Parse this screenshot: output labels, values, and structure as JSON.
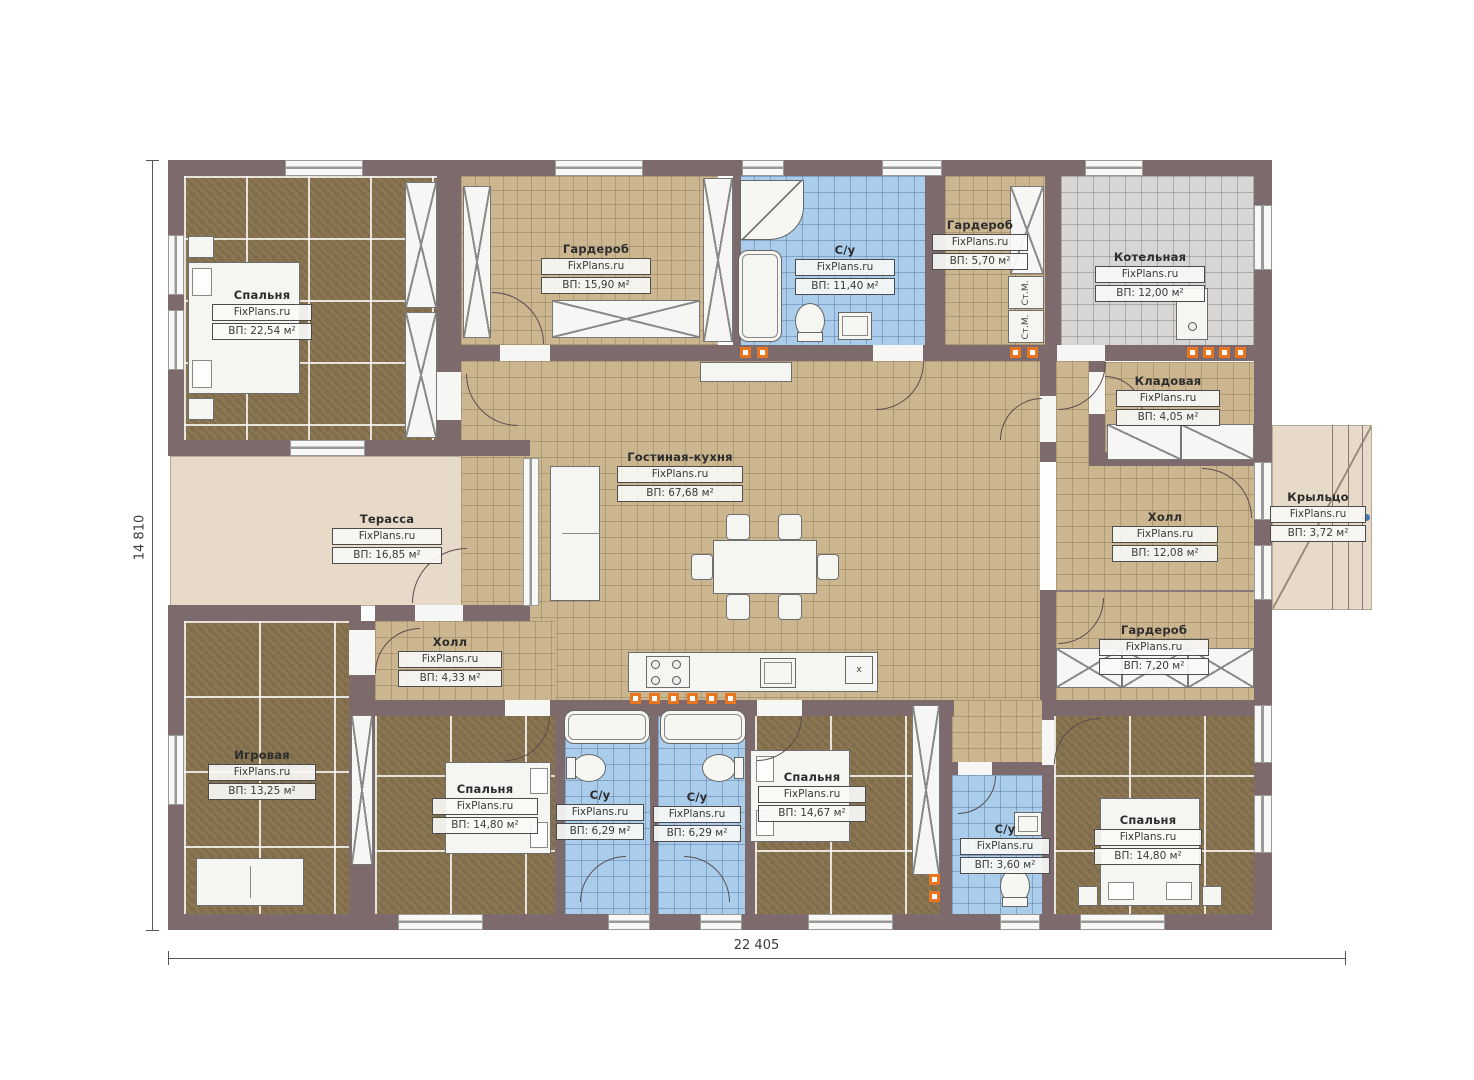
{
  "plan": {
    "title": "Одноэтажный дом — план",
    "watermark": "FixPlans.ru",
    "dimensions": {
      "width_total": "22 405",
      "height_total": "14 810"
    },
    "labels": {
      "washer": "Ст.М.",
      "kitchen_marker": "x"
    },
    "colors": {
      "wall": "#7d6a6c",
      "floor_dark": "#8b7652",
      "floor_tan": "#ccb690",
      "floor_blue": "#aacdec",
      "floor_gray": "#d7d6d4",
      "terrace": "#e7dac8",
      "vent_orange": "#e8751f"
    },
    "rooms": [
      {
        "name": "Спальня",
        "watermark": "FixPlans.ru",
        "area": "ВП: 22,54 м²"
      },
      {
        "name": "Гардероб",
        "watermark": "FixPlans.ru",
        "area": "ВП: 15,90 м²"
      },
      {
        "name": "С/у",
        "watermark": "FixPlans.ru",
        "area": "ВП: 11,40 м²"
      },
      {
        "name": "Гардероб",
        "watermark": "FixPlans.ru",
        "area": "ВП: 5,70 м²"
      },
      {
        "name": "Котельная",
        "watermark": "FixPlans.ru",
        "area": "ВП: 12,00 м²"
      },
      {
        "name": "Кладовая",
        "watermark": "FixPlans.ru",
        "area": "ВП: 4,05 м²"
      },
      {
        "name": "Гостиная-кухня",
        "watermark": "FixPlans.ru",
        "area": "ВП: 67,68 м²"
      },
      {
        "name": "Терасса",
        "watermark": "FixPlans.ru",
        "area": "ВП: 16,85 м²"
      },
      {
        "name": "Холл",
        "watermark": "FixPlans.ru",
        "area": "ВП: 12,08 м²"
      },
      {
        "name": "Крыльцо",
        "watermark": "FixPlans.ru",
        "area": "ВП: 3,72 м²"
      },
      {
        "name": "Гардероб",
        "watermark": "FixPlans.ru",
        "area": "ВП: 7,20 м²"
      },
      {
        "name": "Холл",
        "watermark": "FixPlans.ru",
        "area": "ВП: 4,33 м²"
      },
      {
        "name": "Игровая",
        "watermark": "FixPlans.ru",
        "area": "ВП: 13,25 м²"
      },
      {
        "name": "Спальня",
        "watermark": "FixPlans.ru",
        "area": "ВП: 14,80 м²"
      },
      {
        "name": "С/у",
        "watermark": "FixPlans.ru",
        "area": "ВП: 6,29 м²"
      },
      {
        "name": "С/у",
        "watermark": "FixPlans.ru",
        "area": "ВП: 6,29 м²"
      },
      {
        "name": "Спальня",
        "watermark": "FixPlans.ru",
        "area": "ВП: 14,67 м²"
      },
      {
        "name": "С/у",
        "watermark": "FixPlans.ru",
        "area": "ВП: 3,60 м²"
      },
      {
        "name": "Спальня",
        "watermark": "FixPlans.ru",
        "area": "ВП: 14,80 м²"
      }
    ]
  }
}
